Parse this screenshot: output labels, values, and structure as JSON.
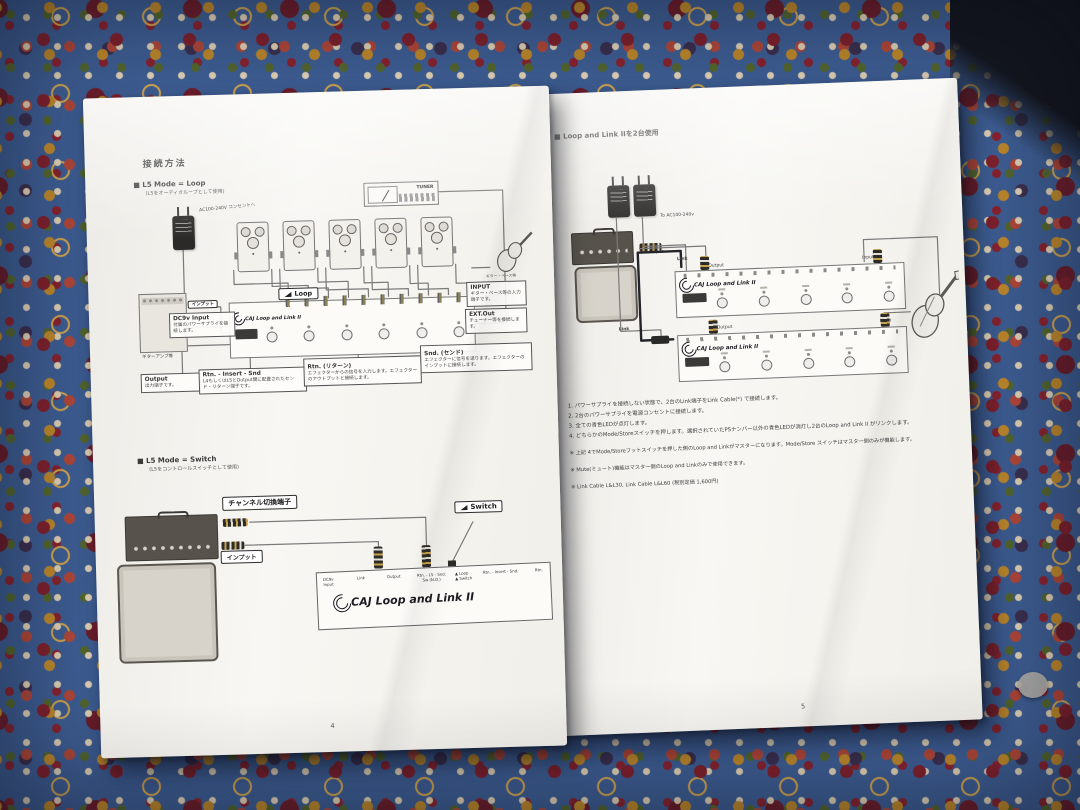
{
  "colors": {
    "carpet_blue": "#3f5f95",
    "paper": "#f5f3ef",
    "ink": "#3c3c3c"
  },
  "page_left": {
    "title": "接続方法",
    "loop_section": {
      "heading": "■  L5 Mode = Loop",
      "subheading": "(L5をオーディオループとして使用)",
      "ac_label": "AC100-240V コンセントへ",
      "tuner_label": "TUNER",
      "loop_tag": "Loop",
      "guitar_label": "ギター・ベース等",
      "amp_input_tag": "インプット",
      "amp_label": "ギターアンプ等",
      "unit_logo": "CAJ  Loop and Link II",
      "callouts": [
        {
          "title": "DC9v Input",
          "body": "付属のパワーサプライを接続します。"
        },
        {
          "title": "INPUT",
          "body": "ギター・ベース等の入力端子です。"
        },
        {
          "title": "EXT.Out",
          "body": "チューナー等を接続します。"
        },
        {
          "title": "Output",
          "body": "出力端子です。"
        },
        {
          "title": "Rtn. - Insert - Snd",
          "body": "L4もしくはL5とOutput間に配置されたセンド・リターン端子です。"
        },
        {
          "title": "Rtn. (リターン)",
          "body": "エフェクターからの信号を入力します。エフェクターのアウトプットと接続します。"
        },
        {
          "title": "Snd. (センド)",
          "body": "エフェクターに信号を送ります。エフェクターのインプットに接続します。"
        }
      ]
    },
    "switch_section": {
      "heading": "■  L5 Mode = Switch",
      "subheading": "(L5をコントロールスイッチとして使用)",
      "channel_tag": "チャンネル切換端子",
      "input_tag": "インプット",
      "switch_tag": "Switch",
      "unit_logo": "CAJ  Loop and Link II",
      "jack_labels": [
        "DC9v\nInput",
        "Link",
        "Output",
        "Rtn. - L5 - Snd.\nSw (N.O.)",
        "▲ Loop\n▲ Switch",
        "Rtn. - Insert - Snd.",
        "Rtn."
      ]
    },
    "page_number": "4"
  },
  "page_right": {
    "heading": "■  Loop and Link IIを2台使用",
    "ac_label": "To AC100-240v",
    "amp_input_label": "Input",
    "unit_logo": "CAJ  Loop and Link II",
    "unit1": {
      "link": "Link",
      "output": "Output",
      "input": "Input"
    },
    "unit2": {
      "link": "Link",
      "output": "Output",
      "input": "Input"
    },
    "steps": [
      "1. パワーサプライを接続しない状態で、2台のLink端子をLink Cable(*) で接続します。",
      "2. 2台のパワーサプライを電源コンセントに接続します。",
      "3. 全ての青色LEDが点灯します。",
      "4. どちらかのMode/Storeスイッチを押します。選択されていたPSナンバー以外の青色LEDが消灯し2台のLoop and Link II がリンクします。"
    ],
    "notes": [
      "※  上記 4でMode/Storeフットスイッチを押した側のLoop and Linkがマスターになります。Mode/Store スイッチはマスター側のみが機能します。",
      "※  Mute(ミュート)機能はマスター側のLoop and Linkのみで使用できます。",
      "※  Link Cable L&L30, Link Cable L&L60 (税別定価 1,600円)"
    ],
    "page_number": "5"
  }
}
